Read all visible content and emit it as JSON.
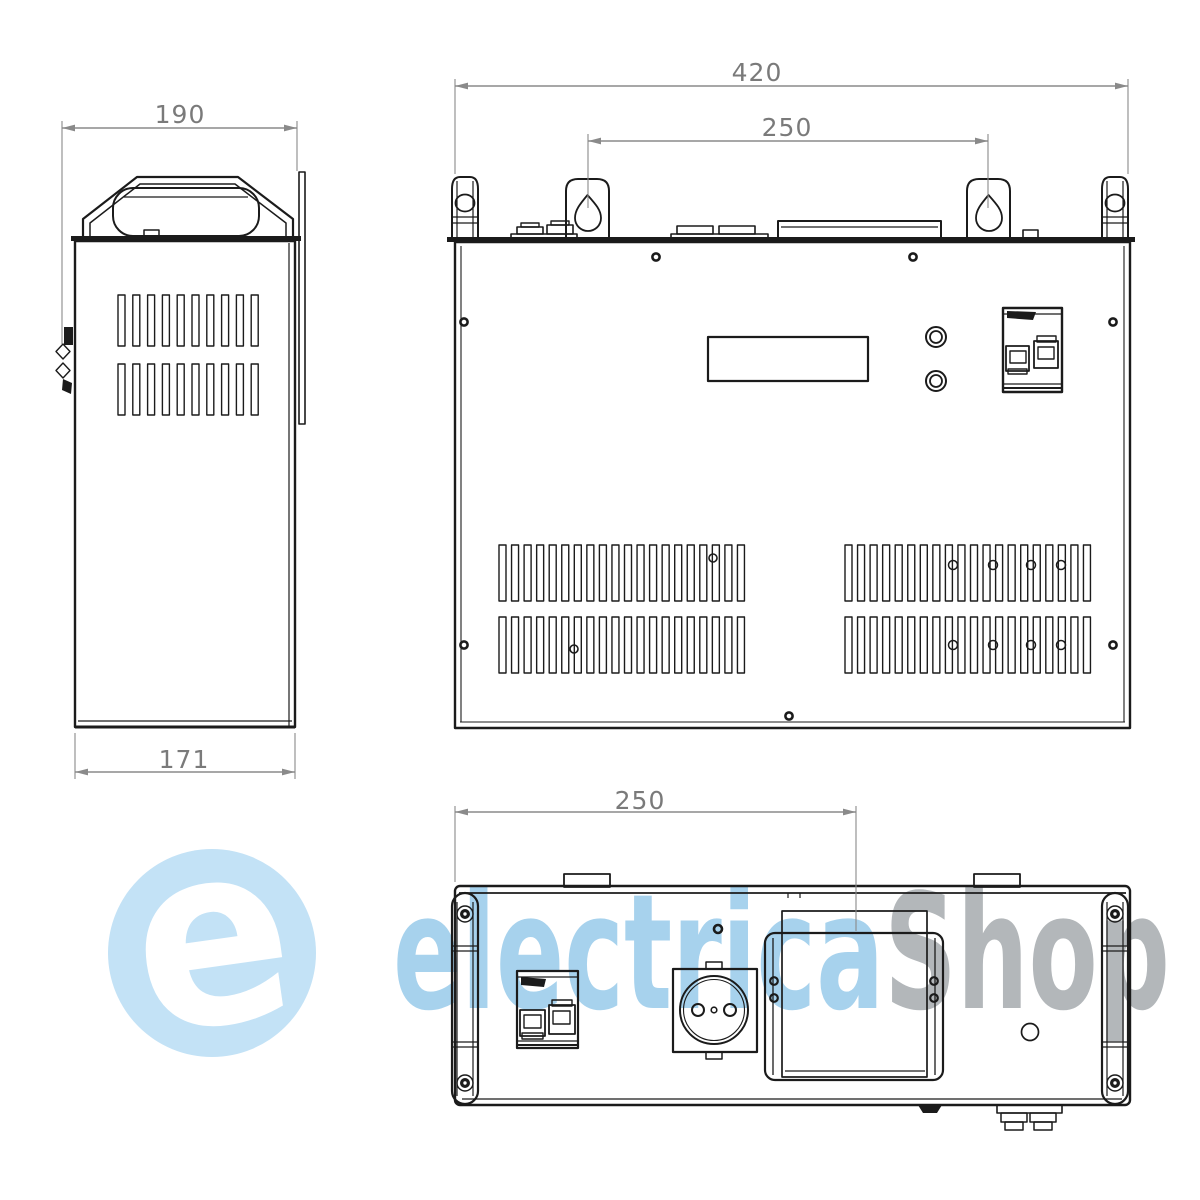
{
  "drawing": {
    "side_view": {
      "dim_top": "190",
      "dim_bottom": "171"
    },
    "front_view": {
      "dim_overall": "420",
      "dim_mount": "250"
    },
    "bottom_view": {
      "dim_mount": "250"
    }
  },
  "watermark": {
    "logo_letter": "e",
    "brand_primary": "electrica",
    "brand_secondary": "Shop",
    "primary_color": "#a7d2ed",
    "secondary_color": "#b3b7ba",
    "logo_circle_color": "#c3e2f6"
  },
  "style": {
    "line_color": "#1b1b1b",
    "dim_line_color": "#8a8a8a",
    "dim_text_color": "#7a7a7a",
    "background": "#ffffff"
  }
}
